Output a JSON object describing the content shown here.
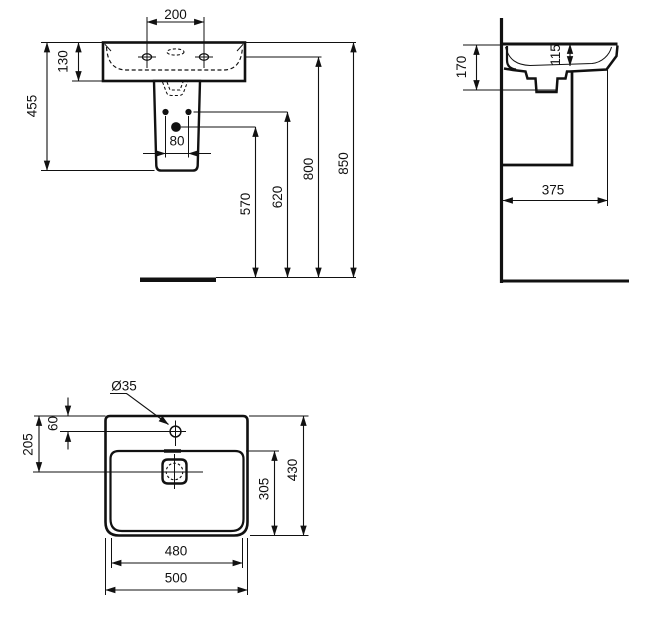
{
  "drawing_type": "washbasin technical dimension drawing",
  "colors": {
    "line": "#111111",
    "background": "#ffffff"
  },
  "dims": {
    "front": {
      "faucet_spacing": "200",
      "rim_to_underside": "130",
      "rim_to_pedestal_bottom": "455",
      "bolt_spacing": "80",
      "drain_height": "570",
      "bolt_height": "620",
      "faucet_height": "800",
      "rim_height": "850"
    },
    "side": {
      "front_apron_height": "170",
      "bowl_depth": "115",
      "wall_to_front": "375"
    },
    "plan": {
      "faucet_hole_diameter": "Ø35",
      "rear_to_faucet": "60",
      "rear_to_drain": "205",
      "bowl_front_depth": "305",
      "overall_depth": "430",
      "bowl_width": "480",
      "overall_width": "500"
    }
  }
}
